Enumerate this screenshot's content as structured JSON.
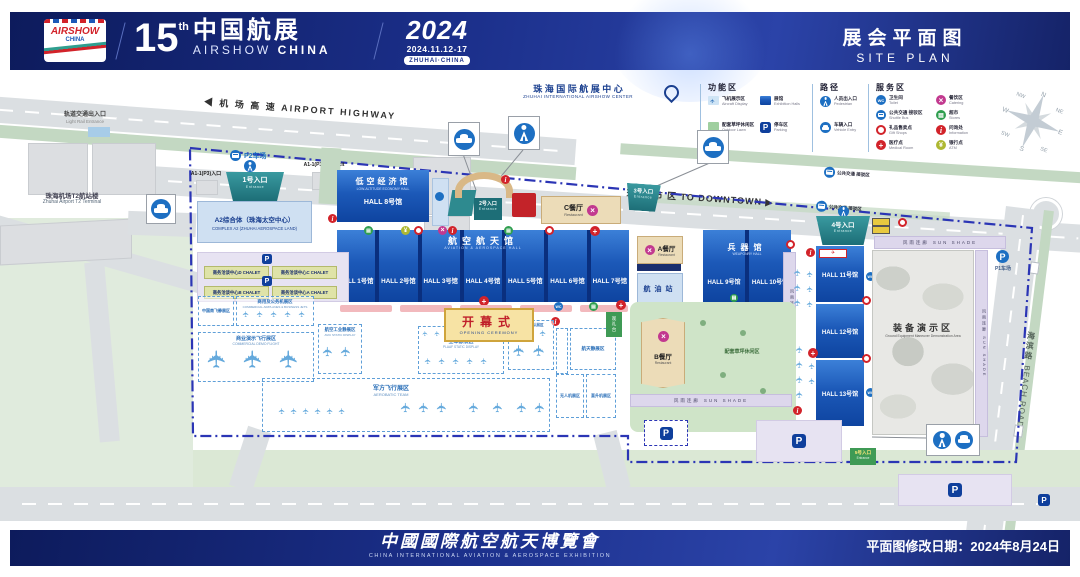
{
  "icons": {
    "plane": "✈",
    "parking": "P",
    "wc": "WC",
    "catering": "×",
    "stores": "▤",
    "info": "i",
    "atm": "¥",
    "medical": "+",
    "arrow_left": "◀",
    "arrow_right": "▶"
  },
  "colors": {
    "header_blue": "#1b2f8a",
    "hall_blue": "#1c59b8",
    "entrance_teal": "#1d6e77",
    "boundary_blue": "#2b35b5",
    "lawn_green": "#cfe4c8",
    "restaurant_tan": "#ecdcb8",
    "alert_red": "#d2232a"
  },
  "header": {
    "logo_line1": "AIRSHOW",
    "logo_line2": "CHINA",
    "num": "15",
    "sup": "th",
    "title_cn": "中国航展",
    "title_en1": "AIRSHOW",
    "title_en2": "CHINA",
    "year": "2024",
    "dates": "2024.11.12-17",
    "city": "ZHUHAI·CHINA",
    "right_cn": "展会平面图",
    "right_en": "SITE PLAN"
  },
  "footer": {
    "title_cn": "中國國際航空航天博覽會",
    "title_en": "CHINA INTERNATIONAL AVIATION & AEROSPACE EXHIBITION",
    "revision": "平面图修改日期：2024年8月24日"
  },
  "legend": {
    "groups": [
      {
        "title": "功能区",
        "items": [
          {
            "cn": "飞机展示区",
            "en": "Aircraft Display"
          },
          {
            "cn": "展馆",
            "en": "Exhibition Halls"
          },
          {
            "cn": "配套草坪休闲区",
            "en": "Outdoor Lawn"
          },
          {
            "cn": "停车区",
            "en": "Parking"
          }
        ]
      },
      {
        "title": "路径",
        "items": [
          {
            "cn": "人员出入口",
            "en": "Pedestrian"
          },
          {
            "cn": "车辆入口",
            "en": "Vehicle Entry"
          }
        ]
      },
      {
        "title": "服务区",
        "items": [
          {
            "cn": "卫生间",
            "en": "Toilet"
          },
          {
            "cn": "公共交通 接驳区",
            "en": "Shuttle Bus"
          },
          {
            "cn": "礼品售卖点",
            "en": "Gift Shops"
          },
          {
            "cn": "医疗点",
            "en": "Medical Room"
          },
          {
            "cn": "餐饮区",
            "en": "Catering"
          },
          {
            "cn": "超市",
            "en": "Stores"
          },
          {
            "cn": "问询处",
            "en": "Information"
          },
          {
            "cn": "银行点",
            "en": "ATM"
          }
        ]
      }
    ],
    "compass": {
      "n": "N",
      "ne": "NE",
      "e": "E",
      "se": "SE",
      "s": "S",
      "sw": "SW",
      "w": "W",
      "nw": "NW"
    }
  },
  "map": {
    "center_title": {
      "cn": "珠 海 国 际 航 展 中 心",
      "en": "ZHUHAI INTERNATIONAL AIRSHOW CENTER"
    },
    "roads": {
      "highway": "◀ 机 场 高 速    AIRPORT HIGHWAY",
      "downtown": "珠 海 市 区    TO DOWNTOWN ▶",
      "beach_cn": "海滨路",
      "beach_en": "BEACH ROAD"
    },
    "west": {
      "light_rail_cn": "轨道交通出入口",
      "light_rail_en": "Light Rail Entrance",
      "hotel_cn": "酒店",
      "hotel_en": "Hotel",
      "terminal_cn": "珠海机场T2航站楼",
      "terminal_en": "Zhuhai Airport T2 Terminal",
      "p2": "P2车场",
      "a1_in": "A1-1(P3)入口",
      "a1_out": "A1-1(P3)出口 Exit"
    },
    "entrances": {
      "e1": "1号入口",
      "e2": "2号入口",
      "e3": "3号入口",
      "e4": "4号入口",
      "e5": "5号入口",
      "en": "Entrance"
    },
    "complex_a2": {
      "cn": "A2综合体（珠海太空中心）",
      "en": "COMPLEX A2 (ZHUHAI AEROSPACE LAND)"
    },
    "hall8": {
      "cn": "低空经济馆",
      "en": "LOW-ALTITUDE ECONOMY HALL",
      "label": "HALL 8号馆"
    },
    "aviation": {
      "cn": "航空航天馆",
      "en": "AVIATION & AEROSPACE HALL",
      "halls": [
        "HALL 1号馆",
        "HALL 2号馆",
        "HALL 3号馆",
        "HALL 4号馆",
        "HALL 5号馆",
        "HALL 6号馆",
        "HALL 7号馆"
      ]
    },
    "weaponry": {
      "cn": "兵器馆",
      "en": "WEAPONRY HALL",
      "halls": [
        "HALL 9号馆",
        "HALL 10号馆"
      ]
    },
    "east_halls": [
      "HALL 11号馆",
      "HALL 12号馆",
      "HALL 13号馆"
    ],
    "restaurants": {
      "a": "A餐厅",
      "b": "B餐厅",
      "c": "C餐厅",
      "en": "Restaurant"
    },
    "fuel_station": "航油站",
    "equipment": {
      "cn": "装备演示区",
      "en": "Ground Equipment Maneuver Demonstration Area"
    },
    "sunshade": {
      "cn": "风雨连廊",
      "en": "SUN SHADE"
    },
    "opening": {
      "cn": "开幕式",
      "en": "OPENING CEREMONY"
    },
    "chalets": [
      "商务洽谈中心D CHALET",
      "商务洽谈中心C CHALET",
      "商务洽谈中心B CHALET",
      "商务洽谈中心A CHALET"
    ],
    "zones": {
      "comac": "中国商飞静展区",
      "jets_cn": "商用及公务机展区",
      "jets_en": "COMMERCIAL AIRPLANES & BUSINESS JETS",
      "demo_cn": "商业演示飞行展区",
      "demo_en": "COMMERCIAL DEMO FLIGHT",
      "avic_cn": "航空工业静展区",
      "avic_en": "AVIC STATIC DISPLAY",
      "plaaf_cn": "空军静展区",
      "plaaf_en": "PLAAF STATIC DISPLAY",
      "aerobatic_cn": "军方飞行展区",
      "aerobatic_en": "AEROBATIC TEAM",
      "team": "飞行表演队展区",
      "aerospace": "航天静展区",
      "uav": "无人机展区",
      "heli": "直升机展区"
    },
    "lawn_label": "配套草坪休闲区",
    "viewing": "观礼台",
    "p1": "P1车场",
    "shuttle_stop": "公共交通 接驳区"
  }
}
